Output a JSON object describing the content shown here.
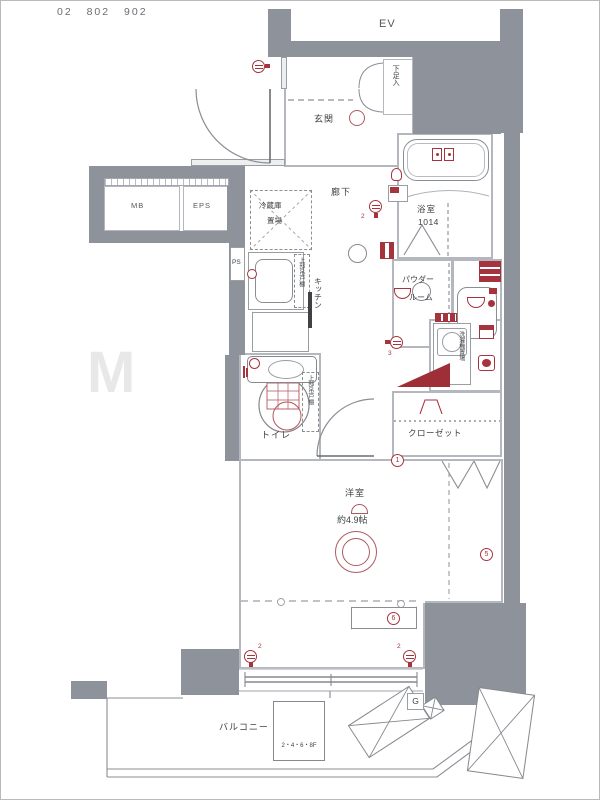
{
  "header": {
    "unit_numbers": "02 802 902"
  },
  "watermark": "M",
  "colors": {
    "wall": "#8e939b",
    "accent": "#a5343e",
    "line": "#85888d"
  },
  "labels": {
    "ev": "EV",
    "entrance": "玄関",
    "shoe_box": "下足入",
    "hallway": "廊下",
    "fridge_space_line1": "冷蔵庫",
    "fridge_space_line2": "置場",
    "kitchen": "キッチン",
    "kitchen_upper_cabinet": "上部吊戸棚",
    "ps": "PS",
    "mb": "MB",
    "eps": "EPS",
    "bathroom": "浴室",
    "bathroom_size": "1014",
    "powder_room_line1": "パウダー",
    "powder_room_line2": "ルーム",
    "laundry_space": "洗濯機置場",
    "closet": "クローゼット",
    "toilet": "トイレ",
    "toilet_upper_cabinet": "上部吊戸棚",
    "main_room": "洋室",
    "main_room_size": "約4.9帖",
    "balcony": "バルコニー",
    "evacuation_hatch_floors": "2・4・6・8F",
    "gas_meter": "G"
  },
  "marks": {
    "hallway_outlet_count": "2",
    "laundry_outlet_count": "3",
    "photo_mark_1": "1",
    "photo_mark_5": "5",
    "photo_mark_6": "6",
    "window_outlet_left_count": "2",
    "window_outlet_right_count": "2"
  }
}
